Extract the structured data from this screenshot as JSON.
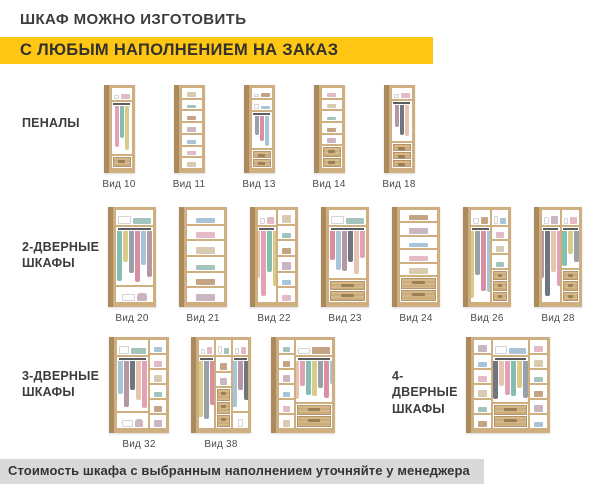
{
  "header": {
    "title": "ШКАФ МОЖНО ИЗГОТОВИТЬ",
    "subtitle": "С ЛЮБЫМ НАПОЛНЕНИЕМ НА ЗАКАЗ"
  },
  "footer": {
    "note": "Стоимость шкафа с выбранным наполнением уточняйте у менеджера"
  },
  "colors": {
    "accent": "#ffc713",
    "footer_bg": "#d9d9d9",
    "text": "#3d3d3d",
    "wood": "#cfae80",
    "wood_dark": "#ab8a5e",
    "clothes_palette": [
      "#e2a2b3",
      "#84bdb2",
      "#d9cc8a",
      "#99a0a8",
      "#d98fa2",
      "#a6c6d8",
      "#b597a4",
      "#6f7680",
      "#e8c3b0"
    ],
    "shelf_item_palette": [
      "#a9c3d9",
      "#e3bac5",
      "#d9cbb0",
      "#a2c4bd",
      "#c4a484",
      "#c9b6c2"
    ]
  },
  "sections": [
    {
      "label": "ПЕНАЛЫ",
      "items": [
        {
          "label": "Вид 10",
          "cols": [
            {
              "wf": 1,
              "z": [
                {
                  "t": "top",
                  "f": 14
                },
                {
                  "t": "hang",
                  "f": 72,
                  "n": 3
                },
                {
                  "t": "drawers",
                  "f": 14,
                  "n": 1
                }
              ]
            }
          ]
        },
        {
          "label": "Вид 11",
          "cols": [
            {
              "wf": 1,
              "z": [
                {
                  "t": "shelves",
                  "f": 100,
                  "n": 7
                }
              ]
            }
          ]
        },
        {
          "label": "Вид 13",
          "cols": [
            {
              "wf": 1,
              "z": [
                {
                  "t": "top",
                  "f": 12
                },
                {
                  "t": "top",
                  "f": 12
                },
                {
                  "t": "hang",
                  "f": 52,
                  "n": 3
                },
                {
                  "t": "drawers",
                  "f": 24,
                  "n": 2
                }
              ]
            }
          ]
        },
        {
          "label": "Вид 14",
          "cols": [
            {
              "wf": 1,
              "z": [
                {
                  "t": "shelves",
                  "f": 74,
                  "n": 5
                },
                {
                  "t": "drawers",
                  "f": 26,
                  "n": 2
                }
              ]
            }
          ]
        },
        {
          "label": "Вид 18",
          "cols": [
            {
              "wf": 1,
              "z": [
                {
                  "t": "top",
                  "f": 13
                },
                {
                  "t": "hang",
                  "f": 55,
                  "n": 3
                },
                {
                  "t": "drawers",
                  "f": 32,
                  "n": 3
                }
              ]
            }
          ]
        }
      ]
    },
    {
      "label": "2-ДВЕРНЫЕ\nШКАФЫ",
      "items": [
        {
          "label": "Вид 20",
          "cols": [
            {
              "wf": 1,
              "z": [
                {
                  "t": "top",
                  "f": 15
                },
                {
                  "t": "hang",
                  "f": 70,
                  "n": 8
                },
                {
                  "t": "open",
                  "f": 15,
                  "i": 2
                }
              ]
            }
          ]
        },
        {
          "label": "Вид 21",
          "cols": [
            {
              "wf": 1,
              "z": [
                {
                  "t": "shelves",
                  "f": 100,
                  "n": 6
                }
              ]
            }
          ]
        },
        {
          "label": "Вид 22",
          "cols": [
            {
              "wf": 1,
              "z": [
                {
                  "t": "top",
                  "f": 15
                },
                {
                  "t": "hang",
                  "f": 85,
                  "n": 4
                }
              ]
            },
            {
              "wf": 1,
              "z": [
                {
                  "t": "shelves",
                  "f": 100,
                  "n": 6
                }
              ]
            }
          ]
        },
        {
          "label": "Вид 23",
          "cols": [
            {
              "wf": 1,
              "z": [
                {
                  "t": "top",
                  "f": 15
                },
                {
                  "t": "hang",
                  "f": 61,
                  "n": 8
                },
                {
                  "t": "drawers",
                  "f": 24,
                  "n": 2
                }
              ]
            }
          ]
        },
        {
          "label": "Вид 24",
          "cols": [
            {
              "wf": 1,
              "z": [
                {
                  "t": "shelves",
                  "f": 74,
                  "n": 5
                },
                {
                  "t": "drawers",
                  "f": 26,
                  "n": 2
                }
              ]
            }
          ]
        },
        {
          "label": "Вид 26",
          "cols": [
            {
              "wf": 11,
              "z": [
                {
                  "t": "top",
                  "f": 15
                },
                {
                  "t": "hang",
                  "f": 85,
                  "n": 4
                }
              ]
            },
            {
              "wf": 9,
              "z": [
                {
                  "t": "top",
                  "f": 15
                },
                {
                  "t": "shelves",
                  "f": 49,
                  "n": 3
                },
                {
                  "t": "drawers",
                  "f": 36,
                  "n": 3
                }
              ]
            }
          ]
        },
        {
          "label": "Вид 28",
          "cols": [
            {
              "wf": 1,
              "z": [
                {
                  "t": "top",
                  "f": 15
                },
                {
                  "t": "hang",
                  "f": 85,
                  "n": 4
                }
              ]
            },
            {
              "wf": 1,
              "z": [
                {
                  "t": "top",
                  "f": 15
                },
                {
                  "t": "hang",
                  "f": 49,
                  "n": 3
                },
                {
                  "t": "drawers",
                  "f": 36,
                  "n": 3
                }
              ]
            }
          ]
        }
      ]
    },
    {
      "label": "3-ДВЕРНЫЕ\nШКАФЫ",
      "items": [
        {
          "label": "Вид 32",
          "cols": [
            {
              "wf": 2,
              "z": [
                {
                  "t": "top",
                  "f": 16
                },
                {
                  "t": "hang",
                  "f": 68,
                  "n": 7
                },
                {
                  "t": "open",
                  "f": 16,
                  "i": 2
                }
              ]
            },
            {
              "wf": 1,
              "z": [
                {
                  "t": "shelves",
                  "f": 100,
                  "n": 6
                }
              ]
            }
          ]
        },
        {
          "label": "Вид 38",
          "cols": [
            {
              "wf": 1,
              "z": [
                {
                  "t": "top",
                  "f": 16
                },
                {
                  "t": "hang",
                  "f": 84,
                  "n": 3
                }
              ]
            },
            {
              "wf": 1,
              "z": [
                {
                  "t": "top",
                  "f": 16
                },
                {
                  "t": "shelves",
                  "f": 37,
                  "n": 2
                },
                {
                  "t": "drawers",
                  "f": 47,
                  "n": 3
                }
              ]
            },
            {
              "wf": 1,
              "z": [
                {
                  "t": "top",
                  "f": 16
                },
                {
                  "t": "hang",
                  "f": 68,
                  "n": 3
                },
                {
                  "t": "open",
                  "f": 16,
                  "i": 1
                }
              ]
            }
          ]
        },
        {
          "label": "",
          "w": 64,
          "cols": [
            {
              "wf": 3,
              "z": [
                {
                  "t": "shelves",
                  "f": 100,
                  "n": 6
                }
              ]
            },
            {
              "wf": 7,
              "z": [
                {
                  "t": "top",
                  "f": 16
                },
                {
                  "t": "hang",
                  "f": 56,
                  "n": 7
                },
                {
                  "t": "drawers",
                  "f": 28,
                  "n": 2
                }
              ]
            }
          ]
        }
      ]
    },
    {
      "label": "4-ДВЕРНЫЕ\nШКАФЫ",
      "items": [
        {
          "label": "",
          "w": 84,
          "cols": [
            {
              "wf": 1,
              "z": [
                {
                  "t": "shelves",
                  "f": 100,
                  "n": 6
                }
              ]
            },
            {
              "wf": 2,
              "z": [
                {
                  "t": "top",
                  "f": 16
                },
                {
                  "t": "hang",
                  "f": 56,
                  "n": 8
                },
                {
                  "t": "drawers",
                  "f": 28,
                  "n": 2
                }
              ]
            },
            {
              "wf": 1,
              "z": [
                {
                  "t": "shelves",
                  "f": 100,
                  "n": 6
                }
              ]
            }
          ]
        }
      ]
    }
  ]
}
